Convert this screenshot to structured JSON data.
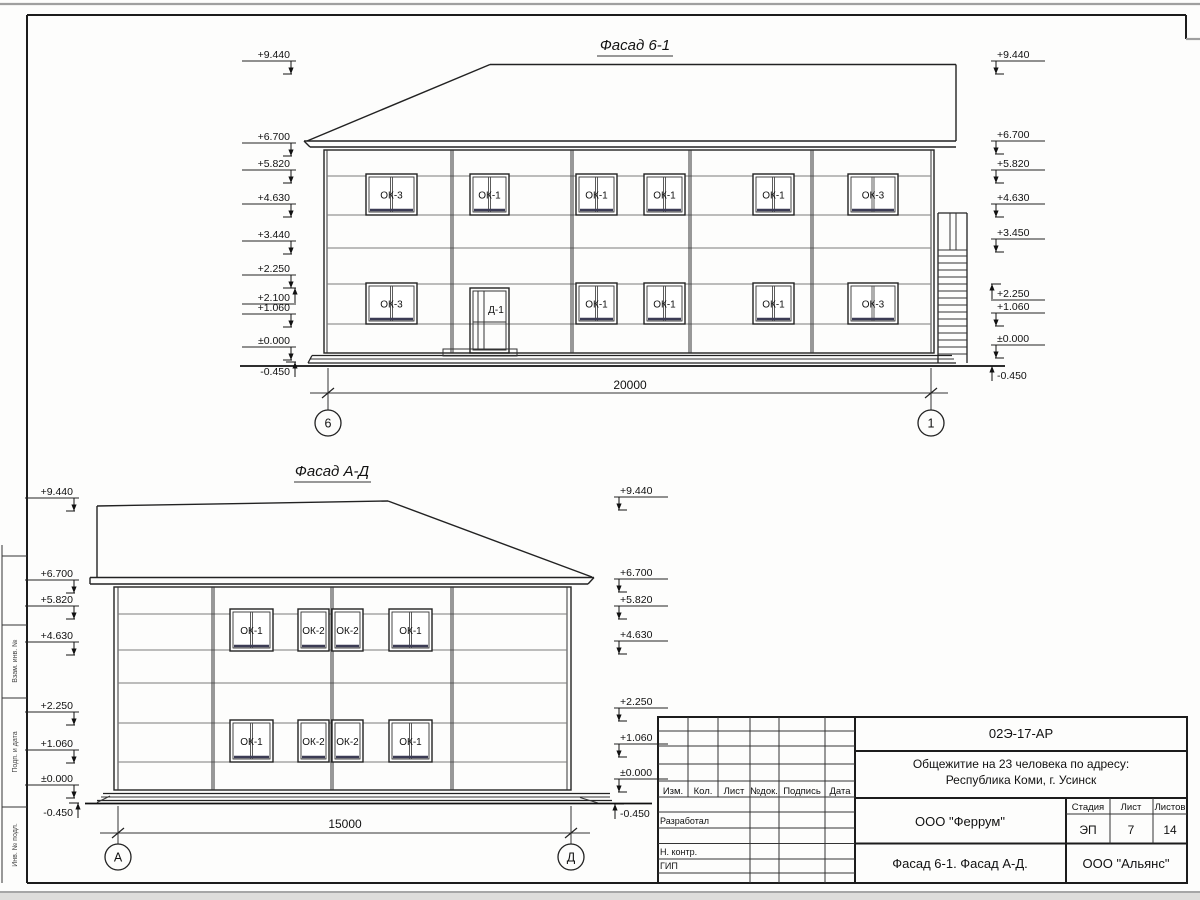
{
  "drawing": {
    "facade1": {
      "title": "Фасад 6-1",
      "dimension": "20000",
      "axis_left": "6",
      "axis_right": "1",
      "door_label": "Д-1",
      "windows_upper": [
        {
          "x": 366,
          "w": 51,
          "label": "ОК-3",
          "m": 1
        },
        {
          "x": 470,
          "w": 39,
          "label": "ОК-1",
          "m": 1
        },
        {
          "x": 576,
          "w": 41,
          "label": "ОК-1",
          "m": 1
        },
        {
          "x": 644,
          "w": 41,
          "label": "ОК-1",
          "m": 1
        },
        {
          "x": 753,
          "w": 41,
          "label": "ОК-1",
          "m": 1
        },
        {
          "x": 848,
          "w": 50,
          "label": "ОК-3",
          "m": 1
        }
      ],
      "windows_lower": [
        {
          "x": 366,
          "w": 51,
          "label": "ОК-3",
          "m": 1
        },
        {
          "x": 576,
          "w": 41,
          "label": "ОК-1",
          "m": 1
        },
        {
          "x": 644,
          "w": 41,
          "label": "ОК-1",
          "m": 1
        },
        {
          "x": 753,
          "w": 41,
          "label": "ОК-1",
          "m": 1
        },
        {
          "x": 848,
          "w": 50,
          "label": "ОК-3",
          "m": 1
        }
      ],
      "marks_left": [
        {
          "t": "+9.440",
          "y": 58,
          "d": "dn"
        },
        {
          "t": "+6.700",
          "y": 140,
          "d": "dn"
        },
        {
          "t": "+5.820",
          "y": 167,
          "d": "dn"
        },
        {
          "t": "+4.630",
          "y": 201,
          "d": "dn"
        },
        {
          "t": "+3.440",
          "y": 238,
          "d": "dn"
        },
        {
          "t": "+2.250",
          "y": 272,
          "d": "dn"
        },
        {
          "t": "+2.100",
          "y": 301,
          "d": "up",
          "u": 1
        },
        {
          "t": "+1.060",
          "y": 311,
          "d": "dn"
        },
        {
          "t": "±0.000",
          "y": 344,
          "d": "dn"
        },
        {
          "t": "-0.450",
          "y": 375,
          "d": "up"
        }
      ],
      "marks_right": [
        {
          "t": "+9.440",
          "y": 58,
          "d": "dn"
        },
        {
          "t": "+6.700",
          "y": 138,
          "d": "dn"
        },
        {
          "t": "+5.820",
          "y": 167,
          "d": "dn"
        },
        {
          "t": "+4.630",
          "y": 201,
          "d": "dn"
        },
        {
          "t": "+3.450",
          "y": 236,
          "d": "dn"
        },
        {
          "t": "+2.250",
          "y": 297,
          "d": "up",
          "u": 1
        },
        {
          "t": "+1.060",
          "y": 310,
          "d": "dn"
        },
        {
          "t": "±0.000",
          "y": 342,
          "d": "dn"
        },
        {
          "t": "-0.450",
          "y": 379,
          "d": "up"
        }
      ]
    },
    "facade2": {
      "title": "Фасад А-Д",
      "dimension": "15000",
      "axis_left": "А",
      "axis_right": "Д",
      "windows_upper": [
        {
          "x": 230,
          "w": 43,
          "label": "ОК-1",
          "m": 1
        },
        {
          "x": 298,
          "w": 31,
          "label": "ОК-2",
          "m": 0
        },
        {
          "x": 332,
          "w": 31,
          "label": "ОК-2",
          "m": 0
        },
        {
          "x": 389,
          "w": 43,
          "label": "ОК-1",
          "m": 1
        }
      ],
      "windows_lower": [
        {
          "x": 230,
          "w": 43,
          "label": "ОК-1",
          "m": 1
        },
        {
          "x": 298,
          "w": 31,
          "label": "ОК-2",
          "m": 0
        },
        {
          "x": 332,
          "w": 31,
          "label": "ОК-2",
          "m": 0
        },
        {
          "x": 389,
          "w": 43,
          "label": "ОК-1",
          "m": 1
        }
      ],
      "marks_left": [
        {
          "t": "+9.440",
          "y": 495,
          "d": "dn"
        },
        {
          "t": "+6.700",
          "y": 577,
          "d": "dn"
        },
        {
          "t": "+5.820",
          "y": 603,
          "d": "dn"
        },
        {
          "t": "+4.630",
          "y": 639,
          "d": "dn"
        },
        {
          "t": "+2.250",
          "y": 709,
          "d": "dn"
        },
        {
          "t": "+1.060",
          "y": 747,
          "d": "dn"
        },
        {
          "t": "±0.000",
          "y": 782,
          "d": "dn"
        },
        {
          "t": "-0.450",
          "y": 816,
          "d": "up"
        }
      ],
      "marks_right": [
        {
          "t": "+9.440",
          "y": 494,
          "d": "dn"
        },
        {
          "t": "+6.700",
          "y": 576,
          "d": "dn"
        },
        {
          "t": "+5.820",
          "y": 603,
          "d": "dn"
        },
        {
          "t": "+4.630",
          "y": 638,
          "d": "dn"
        },
        {
          "t": "+2.250",
          "y": 705,
          "d": "dn"
        },
        {
          "t": "+1.060",
          "y": 741,
          "d": "dn"
        },
        {
          "t": "±0.000",
          "y": 776,
          "d": "dn"
        },
        {
          "t": "-0.450",
          "y": 817,
          "d": "up"
        }
      ]
    }
  },
  "margin_column": {
    "labels": [
      "Взам. инв. №",
      "Подп. и дата",
      "Инв. № подл."
    ]
  },
  "title_block": {
    "doc_number": "02Э-17-АР",
    "project_line1": "Общежитие на 23 человека по адресу:",
    "project_line2": "Республика Коми, г. Усинск",
    "designer_org": "ООО \"Феррум\"",
    "stage_label": "Стадия",
    "sheet_label": "Лист",
    "sheets_label": "Листов",
    "stage": "ЭП",
    "sheet_no": "7",
    "sheets_total": "14",
    "content": "Фасад 6-1. Фасад А-Д.",
    "contractor_org": "ООО \"Альянс\"",
    "columns": [
      "Изм.",
      "Кол.",
      "Лист",
      "№док.",
      "Подпись",
      "Дата"
    ],
    "rows": [
      "Разработал",
      "Н. контр.",
      "ГИП"
    ]
  }
}
